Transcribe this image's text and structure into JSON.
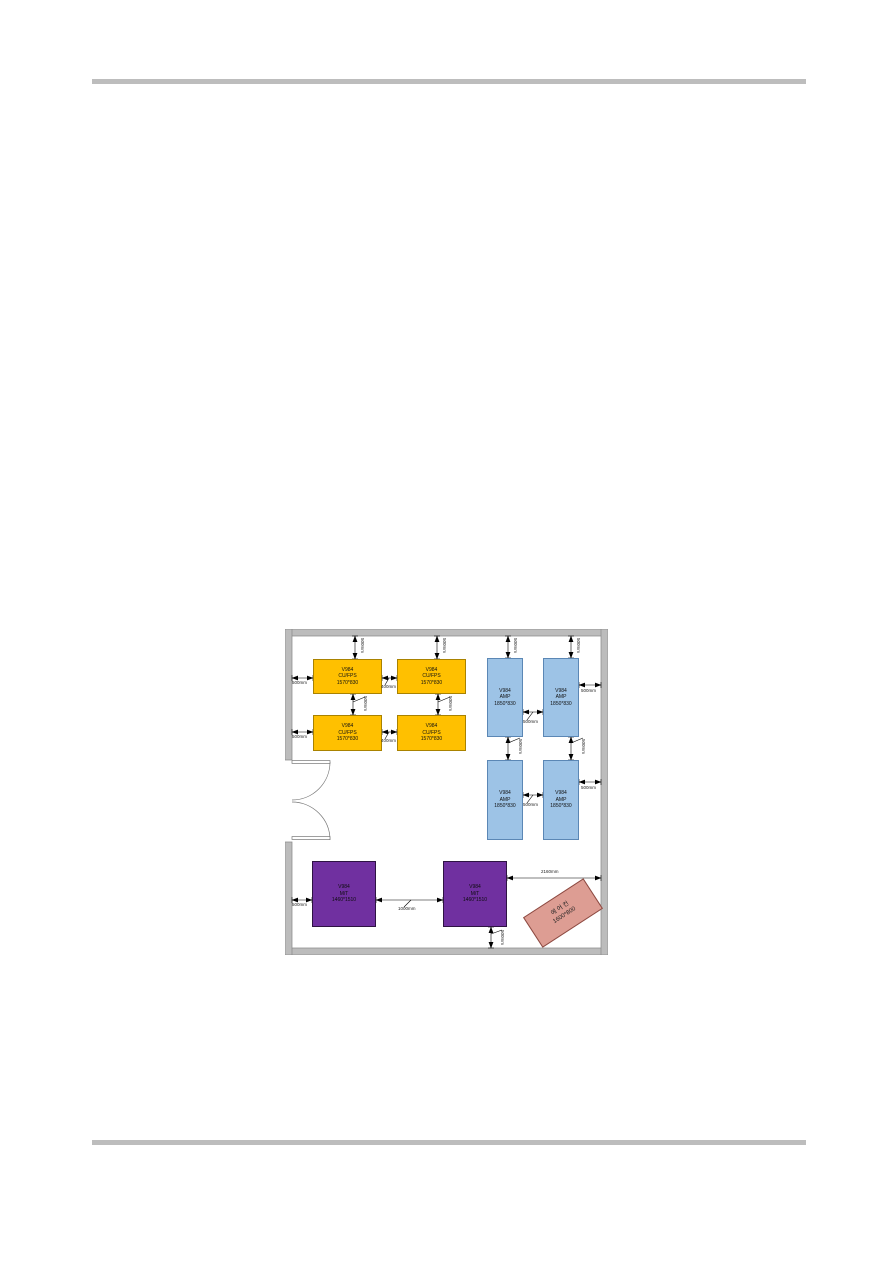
{
  "document": {
    "header_rule_color": "#bdbdbd",
    "footer_rule_color": "#bdbdbd",
    "background": "#ffffff"
  },
  "diagram": {
    "type": "equipment-room-floor-plan",
    "colors": {
      "wall_fill": "#bcbcbc",
      "wall_edge": "#8a8a8a",
      "cu_fps_fill": "#ffc000",
      "amp_fill": "#9dc3e6",
      "mt_fill": "#7030a0",
      "aircon_fill": "#dd9d93",
      "dimension_line": "#000000"
    },
    "blocks": {
      "cu_fps": {
        "line1": "V984",
        "line2": "CU/FPS",
        "line3": "1570*830",
        "count": 4
      },
      "amp": {
        "line1": "V984",
        "line2": "AMP",
        "line3": "1850*830",
        "count": 4
      },
      "mt": {
        "line1": "V984",
        "line2": "M/T",
        "line3": "1460*1510",
        "count": 2
      },
      "aircon": {
        "line1": "에 어 컨",
        "line2": "1600*800",
        "count": 1
      }
    },
    "dims": {
      "d400": "400mm",
      "d500": "500mm",
      "d1000": "1000mm",
      "d2160": "2160mm"
    }
  }
}
